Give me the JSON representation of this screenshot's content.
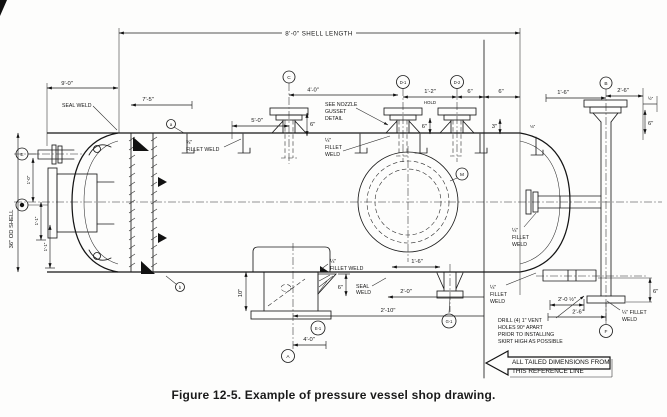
{
  "figure": {
    "caption": "Figure 12-5. Example of pressure vessel shop drawing."
  },
  "dims": {
    "shell_length": "8'-0\" SHELL LENGTH",
    "left_oal": "9'-0\"",
    "seam_offset": "7'-5\"",
    "clip_span": "5'-0\"",
    "nozzle_c": "4'-0\"",
    "d_spacing": "1'-2\"",
    "d_spacing_note": "HOLD",
    "c_height": "6\"",
    "d_height": "6\"",
    "ref_a": "6\"",
    "ref_b": "6\"",
    "ref_c": "3\"",
    "clip_weld": "⅛\"",
    "b_left": "1'-6\"",
    "b_right": "2'-6\"",
    "b_half": "½\"",
    "b_height": "6\"",
    "od": "36\" OD SHELL",
    "head_a": "1'-0\"",
    "head_b": "1'-1\"",
    "head_c": "1'-1\"",
    "skirt_height": "10\"",
    "gusset_height": "6\"",
    "seal_offset": "2'-0\"",
    "skirt_offset": "2'-10\"",
    "skirt_nozzle": "4'-0\"",
    "circle_offset": "1'-6\"",
    "br_a": "2'-0 ½\"",
    "br_b": "2'-6\"",
    "br_height": "6\""
  },
  "notes": {
    "seal_weld": "SEAL WELD",
    "fillet34_size": "¾\"",
    "fillet_weld": "FILLET WELD",
    "gusset_1": "SEE NOZZLE",
    "gusset_2": "GUSSET",
    "gusset_3": "DETAIL",
    "q_size": "¼\"",
    "q_fillet": "FILLET",
    "q_weld": "WELD",
    "q_fillet_inline": "¼\" FILLET",
    "seal_1": "SEAL",
    "seal_2": "WELD",
    "drill_1": "DRILL (4) 1\" VENT",
    "drill_2": "HOLES 90° APART",
    "drill_3": "PRIOR TO INSTALLING",
    "drill_4": "SKIRT HIGH AS POSSIBLE",
    "banner_1": "ALL TAILED DIMENSIONS FROM",
    "banner_2": "THIS REFERENCE LINE"
  },
  "balloons": {
    "e": "E",
    "c": "C",
    "d1": "D-1",
    "d2": "D-2",
    "b": "B",
    "m": "M",
    "e1": "E-1",
    "a": "A",
    "g1": "G-1",
    "f": "F",
    "flag_a": "a",
    "flag_b": "b"
  }
}
